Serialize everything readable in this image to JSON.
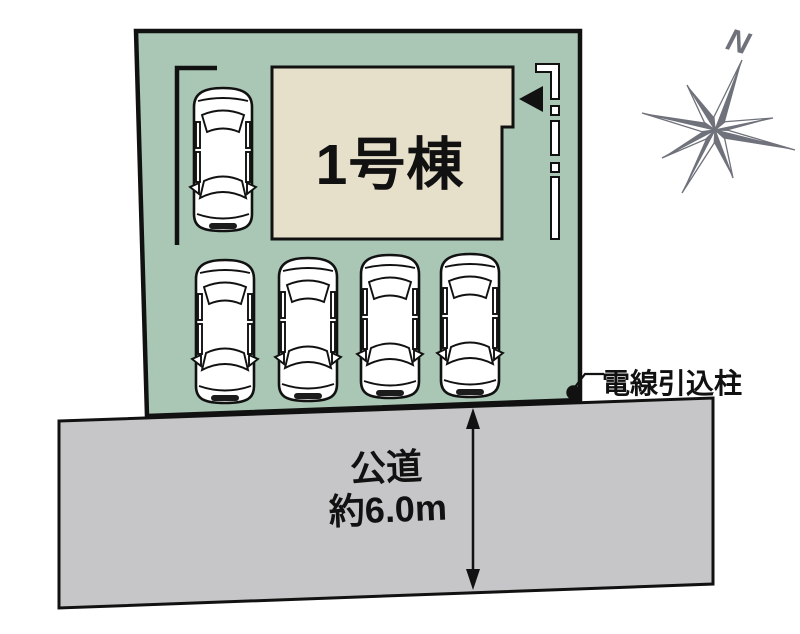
{
  "plot": {
    "building": {
      "label": "1号棟"
    },
    "parking": {
      "car_count": 5
    },
    "power_pole": {
      "label": "電線引込柱"
    }
  },
  "road": {
    "name": "公道",
    "width": "約6.0m"
  },
  "compass": {
    "north": "N"
  },
  "colors": {
    "plot_green": "#a9c7b4",
    "building_beige": "#e6e0cb",
    "road_gray": "#c6c6c8",
    "compass_gray": "#6f727b",
    "line_black": "#111111"
  }
}
